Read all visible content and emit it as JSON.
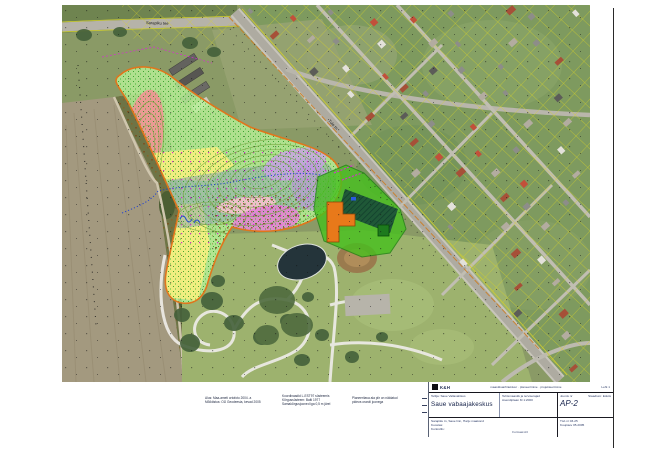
{
  "map": {
    "road_label_top": "Sarapiku tee",
    "road_label_diagonal": "Tule tn"
  },
  "notes": {
    "block1": [
      "Alus: Maa-ameti ortofoto 2004. a",
      "Mõõdistus: OÜ Geodeesia, kevad 2005"
    ],
    "block2": [
      "Koordinaadid L-EST97 süsteemis",
      "Kõrgussüsteem: Balti 1977",
      "Samakõrgusjooned iga 0,5 m järel"
    ],
    "block3": [
      "Planeeritava ala piir on näidatud",
      "pideva oranži joonega"
    ]
  },
  "titleblock": {
    "logo_text": "K&H",
    "row1_center": "maastikuarhitektuur · planeerimine · projekteerimine",
    "row1_right": "Leht 1",
    "object_caption": "Tellija: Saue Vallavalitsus",
    "title_main": "Saue vabaajakeskus",
    "mid_line1": "Tehismaastik ja terviserajad",
    "mid_line2": "Asendiplaan M 1:2000",
    "stage_label": "Staadium: Eskiis",
    "sheet_label": "Joonis nr",
    "sheet_number": "AP-2",
    "row3_left_title": "Sarapiku tn, Saue linn, Harju maakond",
    "row3_left_sub1": "Koostas:",
    "row3_left_sub2": "Kontrollis:",
    "row3_right_line1": "Töö nr  03-25",
    "row3_right_line2": "Kuupäev  05.2005",
    "bottom_note": "Formaat A3"
  },
  "colors": {
    "overlay_green": "#b7ef97",
    "boundary_orange": "#e0761c",
    "building_orange": "#e8791a",
    "school_green": "#46c01e",
    "cadastral_yellow": "#d8d426",
    "stream_blue": "#1f3fd1",
    "magenta_area": "#e67fd6",
    "salmon_area": "#ef9393",
    "yellow_area": "#f5ee7e"
  }
}
